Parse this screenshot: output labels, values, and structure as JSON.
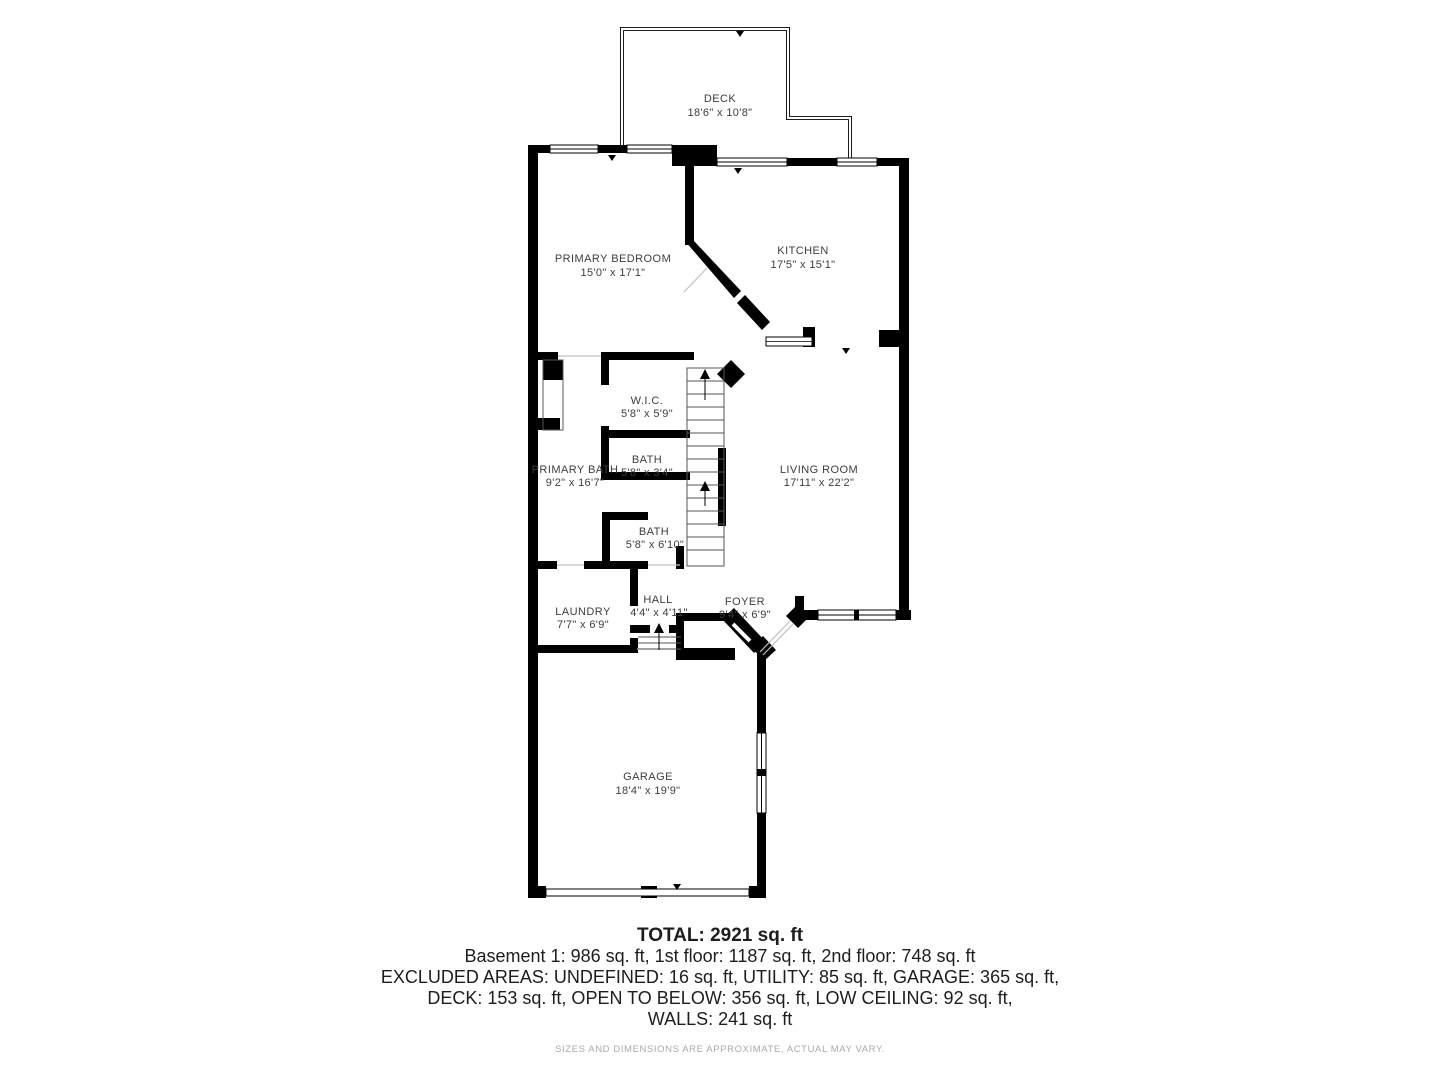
{
  "plan": {
    "rooms": [
      {
        "name": "DECK",
        "dims": "18'6\" x 10'8\""
      },
      {
        "name": "PRIMARY BEDROOM",
        "dims": "15'0\" x 17'1\""
      },
      {
        "name": "KITCHEN",
        "dims": "17'5\" x 15'1\""
      },
      {
        "name": "W.I.C.",
        "dims": "5'8\" x 5'9\""
      },
      {
        "name": "BATH",
        "dims": "5'8\" x 3'4\""
      },
      {
        "name": "PRIMARY BATH",
        "dims": "9'2\" x 16'7\""
      },
      {
        "name": "BATH",
        "dims": "5'8\" x 6'10\""
      },
      {
        "name": "LIVING ROOM",
        "dims": "17'11\" x 22'2\""
      },
      {
        "name": "LAUNDRY",
        "dims": "7'7\" x 6'9\""
      },
      {
        "name": "HALL",
        "dims": "4'4\" x 4'11\""
      },
      {
        "name": "FOYER",
        "dims": "9'4\" x 6'9\""
      },
      {
        "name": "GARAGE",
        "dims": "18'4\" x 19'9\""
      }
    ]
  },
  "summary": {
    "total": "TOTAL: 2921 sq. ft",
    "line1": "Basement 1: 986 sq. ft, 1st floor: 1187 sq. ft, 2nd floor: 748 sq. ft",
    "line2": "EXCLUDED AREAS: UNDEFINED: 16 sq. ft, UTILITY: 85 sq. ft, GARAGE: 365 sq. ft,",
    "line3": "DECK: 153 sq. ft, OPEN TO BELOW: 356 sq. ft, LOW CEILING: 92 sq. ft,",
    "line4": "WALLS: 241 sq. ft"
  },
  "disclaimer": "SIZES AND DIMENSIONS ARE APPROXIMATE, ACTUAL MAY VARY.",
  "colors": {
    "wall": "#000000",
    "label": "#3d3d3d",
    "door_line": "#c0c0c0",
    "disclaimer": "#aaaaaa"
  }
}
